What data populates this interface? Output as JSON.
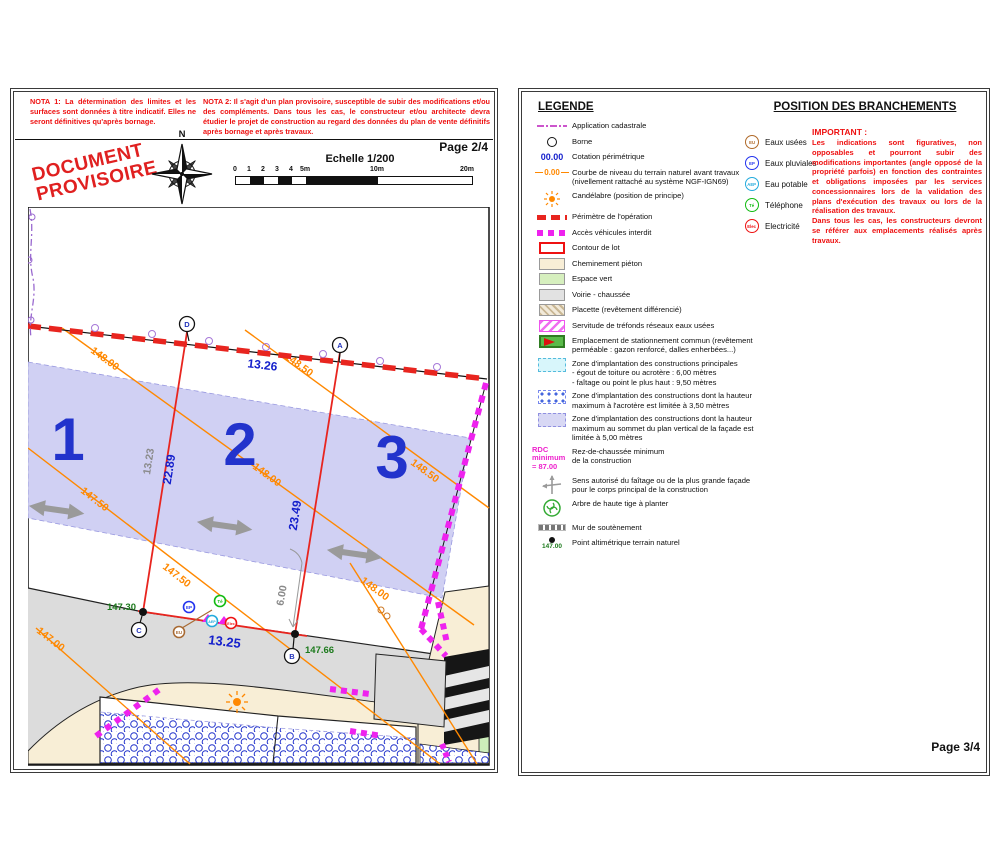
{
  "left_page": {
    "nota1": "NOTA 1: La détermination des limites et les surfaces sont données à titre indicatif. Elles ne  seront définitives qu'après bornage.",
    "nota2": "NOTA 2: Il s'agit d'un plan provisoire, susceptible de subir des modifications et/ou des compléments. Dans tous les cas, le constructeur et/ou architecte devra étudier le projet de construction au regard des données du plan de vente définitifs après bornage et après travaux.",
    "stamp": "DOCUMENT\nPROVISOIRE",
    "compass_north": "N",
    "page_label": "Page 2/4",
    "scale_title": "Echelle 1/200",
    "scale_ticks": [
      "0",
      "1",
      "2",
      "3",
      "4",
      "5m",
      "10m",
      "20m"
    ],
    "plan": {
      "lot_numbers": {
        "lot1": "1",
        "lot2": "2",
        "lot3": "3"
      },
      "point_letters": {
        "a": "A",
        "b": "B",
        "c": "C",
        "d": "D"
      },
      "dimensions": {
        "top": "13.26",
        "bottom": "13.25",
        "left_blue": "22.89",
        "right_blue": "23.49",
        "left_gray": "13.23",
        "setback": "6.00"
      },
      "spot_levels": {
        "at_c": "147.30",
        "at_b": "147.66"
      },
      "contour_labels": {
        "c1485a": "148.50",
        "c1485b": "148.50",
        "c148a": "148.00",
        "c148b": "148.00",
        "c148c": "148.00",
        "c1475a": "147.50",
        "c1475b": "147.50",
        "c147": "147.00"
      }
    }
  },
  "right_page": {
    "legend_title": "LEGENDE",
    "legend": {
      "items": [
        {
          "label": "Application cadastrale"
        },
        {
          "label": "Borne"
        },
        {
          "label": "Cotation périmétrique",
          "swatch": "00.00"
        },
        {
          "label": "Courbe de niveau du terrain naturel avant travaux (nivellement rattaché au système NGF-IGN69)",
          "swatch": "0.00"
        },
        {
          "label": "Candélabre (position de principe)"
        },
        {
          "label": "Périmètre de l'opération"
        },
        {
          "label": "Accès véhicules interdit"
        },
        {
          "label": "Contour de lot"
        },
        {
          "label": "Cheminement piéton"
        },
        {
          "label": "Espace vert"
        },
        {
          "label": "Voirie - chaussée"
        },
        {
          "label": "Placette (revêtement différencié)"
        },
        {
          "label": "Servitude de tréfonds réseaux eaux usées"
        },
        {
          "label": "Emplacement de stationnement commun (revêtement perméable : gazon renforcé, dalles enherbées...)"
        },
        {
          "label": "Zone d'implantation des constructions principales\n- égout de toiture ou acrotère : 6,00 mètres\n- faîtage ou point le plus haut : 9,50 mètres"
        },
        {
          "label": "Zone d'implantation des constructions dont la hauteur maximum à l'acrotère est limitée à 3,50 mètres"
        },
        {
          "label": "Zone d'implantation des constructions dont la hauteur maximum au sommet du  plan vertical de la façade est limitée à 5,00 mètres"
        },
        {
          "label": "Rez-de-chaussée minimum\nde la construction",
          "swatch": "RDC minimum\n= 87.00"
        },
        {
          "label": "Sens autorisé du faîtage ou de la plus grande façade\npour le corps principal de la construction"
        },
        {
          "label": "Arbre de haute tige à planter"
        },
        {
          "label": "Mur de soutènement"
        },
        {
          "label": "Point altimétrique terrain naturel",
          "swatch": "147.00"
        }
      ]
    },
    "branchements_title": "POSITION DES BRANCHEMENTS",
    "utilities": [
      {
        "abbr": "EU",
        "label": "Eaux usées",
        "color": "#b06a2a"
      },
      {
        "abbr": "EP",
        "label": "Eaux pluviales",
        "color": "#2233ee"
      },
      {
        "abbr": "AEP",
        "label": "Eau potable",
        "color": "#22aadd"
      },
      {
        "abbr": "Té",
        "label": "Téléphone",
        "color": "#11bb11"
      },
      {
        "abbr": "Elec",
        "label": "Electricité",
        "color": "#ee1111"
      }
    ],
    "important_title": "IMPORTANT :",
    "important_body": "Les indications sont figuratives, non opposables et pourront subir des modifications importantes (angle opposé de la propriété parfois) en fonction des contraintes et obligations imposées par les services concessionnaires lors de la validation des plans d'exécution des travaux ou lors de la réalisation des travaux.\nDans tous les cas, les constructeurs devront se référer aux emplacements réalisés après travaux.",
    "page_label": "Page 3/4"
  },
  "colors": {
    "perimeter_red": "#e8251f",
    "access_magenta": "#ee22ee",
    "contour_orange": "#ff8800",
    "dimension_blue": "#1520cc",
    "implantation_lavender": "#cdcdf2",
    "note_red": "#ee1111",
    "spot_level_green": "#1c7a1c"
  }
}
